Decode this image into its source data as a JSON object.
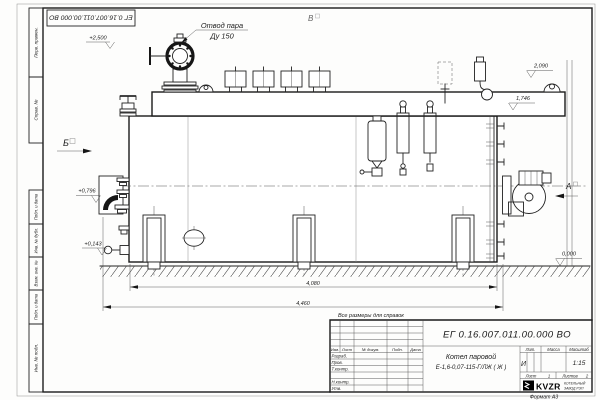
{
  "frame": {
    "designation_flipped": "ЕГ 0.16.007.011.00.000  ВО",
    "format_note": "Формат А3",
    "margins": {
      "col1": "Перв. примен.",
      "col2": "Справ. №",
      "col3": "Подп. и дата",
      "col4": "Инв. № дубл.",
      "col5": "Взам. инв. №",
      "col6": "Подп. и дата",
      "col7": "Инв. № подл."
    }
  },
  "drawing": {
    "steam_outlet_label_1": "Отвод пара",
    "steam_outlet_label_2": "Ду 150",
    "view_b": "Б",
    "view_v": "В",
    "view_a": "А",
    "elev_plus_2500": "+2,500",
    "elev_plus_0796": "+0,796",
    "elev_plus_0143": "+0,143",
    "elev_2090": "2,090",
    "elev_1746": "1,746",
    "elev_0000": "0,000",
    "dim_length_inner": "4,080",
    "dim_length_outer": "4,460",
    "reference_note": "Все размеры для справок"
  },
  "title_block": {
    "designation": "ЕГ 0.16.007.011.00.000  ВО",
    "product_line1": "Котел паровой",
    "product_line2": "Е-1,6-0,07-115-Г/ЛЖ ( Ж )",
    "col_izm": "Изм.",
    "col_list": "Лист",
    "col_doc": "№ докум.",
    "col_sign": "Подп.",
    "col_date": "Дата",
    "row_razrab": "Разраб.",
    "row_prov": "Пров.",
    "row_tkontr": "Т.контр.",
    "row_nkontr": "Н.контр.",
    "row_utv": "Утв.",
    "litera_header": "Лит.",
    "mass_header": "Масса",
    "scale_header": "Масштаб",
    "litera_value": "И",
    "scale_value": "1:15",
    "sheet_label": "Лист",
    "sheet_value": "1",
    "sheets_label": "Листов",
    "sheets_value": "2",
    "logo": "KVZR",
    "logo_sub1": "КОТЕЛЬНЫЙ",
    "logo_sub2": "ЗАВОД РЭП"
  }
}
